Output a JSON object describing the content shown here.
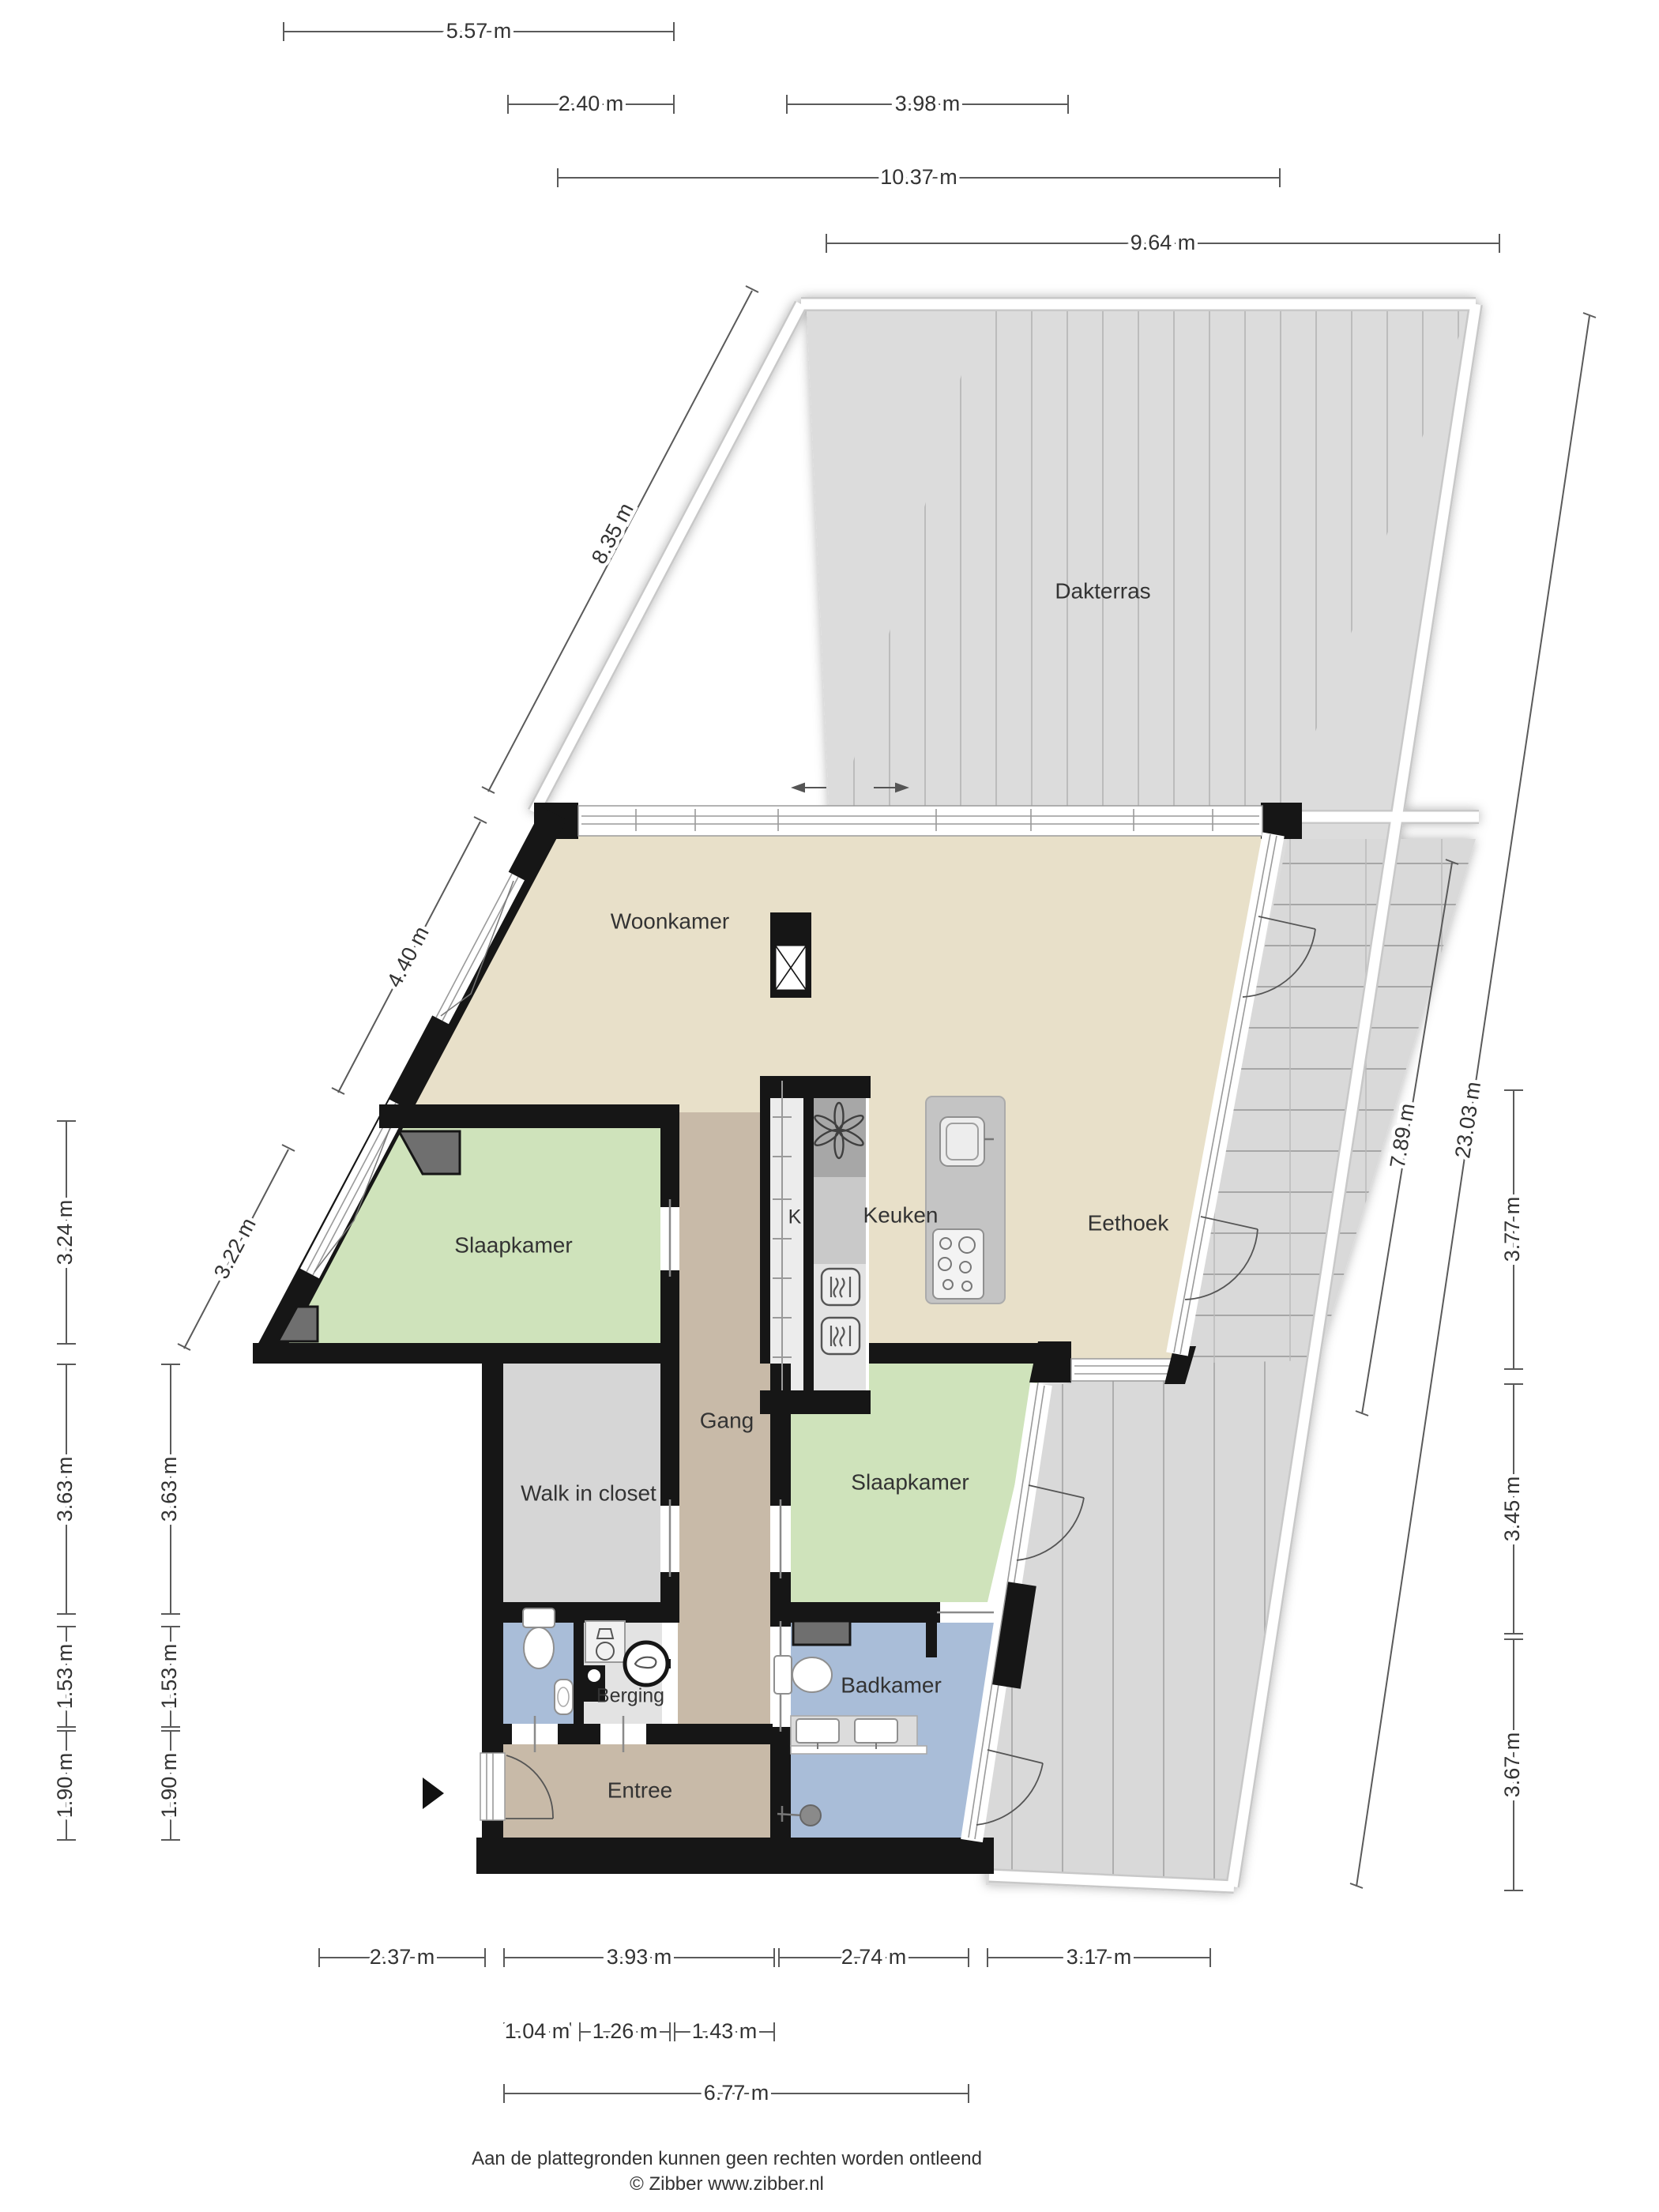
{
  "plan_type": "floorplan",
  "colors": {
    "wall": "#161616",
    "floor_living": "#e8e0c9",
    "floor_bedroom": "#cfe3bb",
    "floor_bath": "#a9bdd8",
    "floor_hall": "#c8baa8",
    "floor_closet": "#d6d6d6",
    "floor_storage": "#e3e3e3",
    "terrace": "#dcdcdc",
    "dim_line": "#5a5a5a",
    "text": "#333333"
  },
  "rooms": {
    "dakterras": {
      "label": "Dakterras"
    },
    "woonkamer": {
      "label": "Woonkamer"
    },
    "keuken": {
      "label": "Keuken"
    },
    "eethoek": {
      "label": "Eethoek"
    },
    "kast": {
      "label": "K"
    },
    "slaapkamer1": {
      "label": "Slaapkamer"
    },
    "gang": {
      "label": "Gang"
    },
    "walkincloset": {
      "label": "Walk in closet"
    },
    "slaapkamer2": {
      "label": "Slaapkamer"
    },
    "berging": {
      "label": "Berging"
    },
    "badkamer": {
      "label": "Badkamer"
    },
    "entree": {
      "label": "Entree"
    }
  },
  "dims": {
    "top": [
      {
        "label": "5.57 m"
      },
      {
        "label": "2.40 m"
      },
      {
        "label": "3.98 m"
      },
      {
        "label": "10.37 m"
      },
      {
        "label": "9.64 m"
      }
    ],
    "diag_left": [
      {
        "label": "8.35 m"
      },
      {
        "label": "4.40 m"
      },
      {
        "label": "3.22 m"
      }
    ],
    "left_outer": [
      {
        "label": "3.24 m"
      },
      {
        "label": "3.63 m"
      },
      {
        "label": "1.53 m"
      },
      {
        "label": "1.90 m"
      }
    ],
    "left_inner": [
      {
        "label": "3.63 m"
      },
      {
        "label": "1.53 m"
      },
      {
        "label": "1.90 m"
      }
    ],
    "right": [
      {
        "label": "7.89 m"
      },
      {
        "label": "23.03 m"
      },
      {
        "label": "3.77 m"
      },
      {
        "label": "3.45 m"
      },
      {
        "label": "3.67 m"
      }
    ],
    "bottom_r1": [
      {
        "label": "2.37 m"
      },
      {
        "label": "3.93 m"
      },
      {
        "label": "2.74 m"
      },
      {
        "label": "3.17 m"
      }
    ],
    "bottom_r2": [
      {
        "label": "1.04 m"
      },
      {
        "label": "1.26 m"
      },
      {
        "label": "1.43 m"
      }
    ],
    "bottom_r3": [
      {
        "label": "6.77 m"
      }
    ]
  },
  "footer": {
    "line1": "Aan de plattegronden kunnen geen rechten worden ontleend",
    "line2": "© Zibber www.zibber.nl"
  }
}
